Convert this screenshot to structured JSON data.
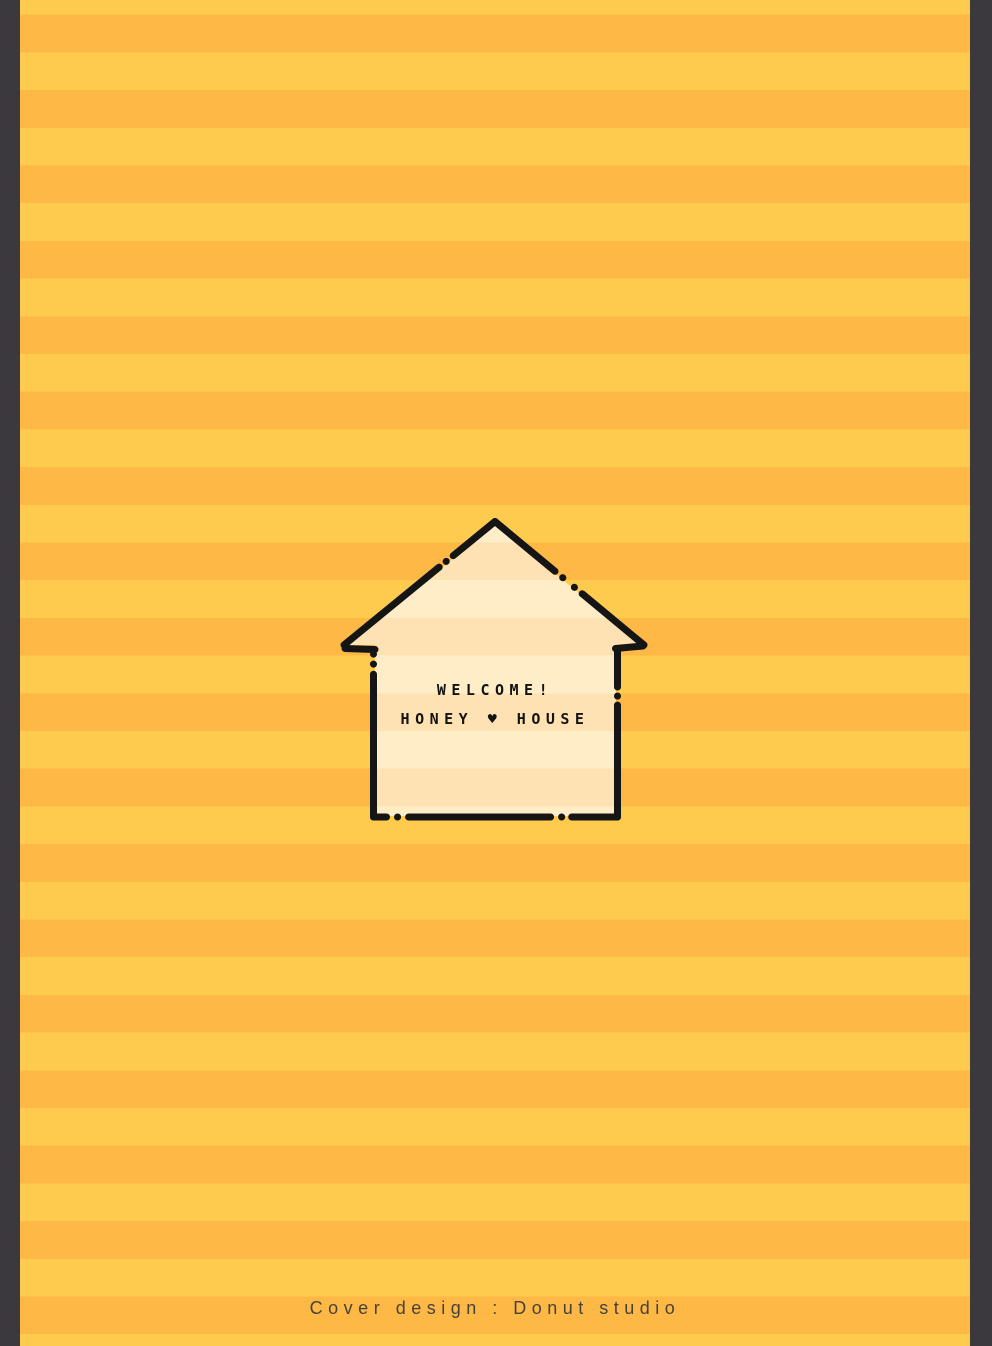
{
  "frame": {
    "color": "#3b383e",
    "left_bar_width_px": 20,
    "right_bar_width_px": 22
  },
  "background": {
    "stripe_light_color": "#ffcb4e",
    "stripe_dark_color": "#fdb846",
    "stripe_height_px": 37.7,
    "orientation": "horizontal"
  },
  "house": {
    "fill_stripe_light_color": "#ffedc8",
    "fill_stripe_dark_color": "#ffe2b4",
    "outline_color": "#151515",
    "outline_style": "dashed-with-dots",
    "line1": "WELCOME!",
    "line2_left": "HONEY",
    "heart_icon": "♥",
    "line2_right": "HOUSE",
    "text_color": "#131313"
  },
  "credit": {
    "text": "Cover design : Donut studio",
    "color": "#45423c"
  }
}
